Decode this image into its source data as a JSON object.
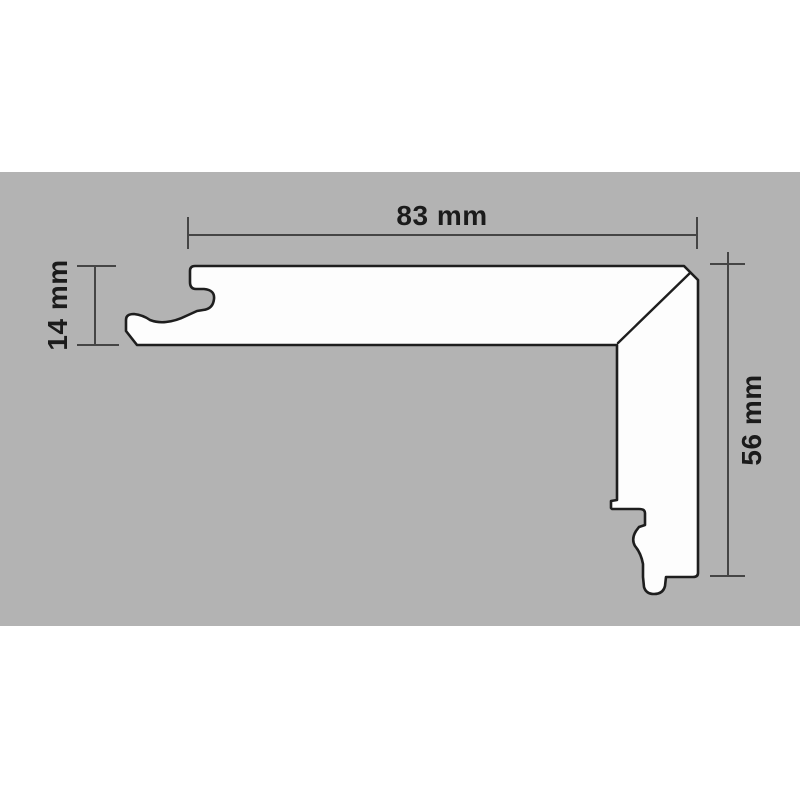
{
  "drawing": {
    "labels": {
      "width": "83 mm",
      "height": "56 mm",
      "thickness": "14 mm"
    },
    "values_mm": {
      "width": 83,
      "height": 56,
      "thickness": 14
    },
    "colors": {
      "page_background": "#ffffff",
      "background_band": "#b3b3b3",
      "profile_fill": "#fdfdfd",
      "outline": "#1e1e1e",
      "dimension_lines": "#454545",
      "dimension_text": "#1b1b1b"
    }
  }
}
